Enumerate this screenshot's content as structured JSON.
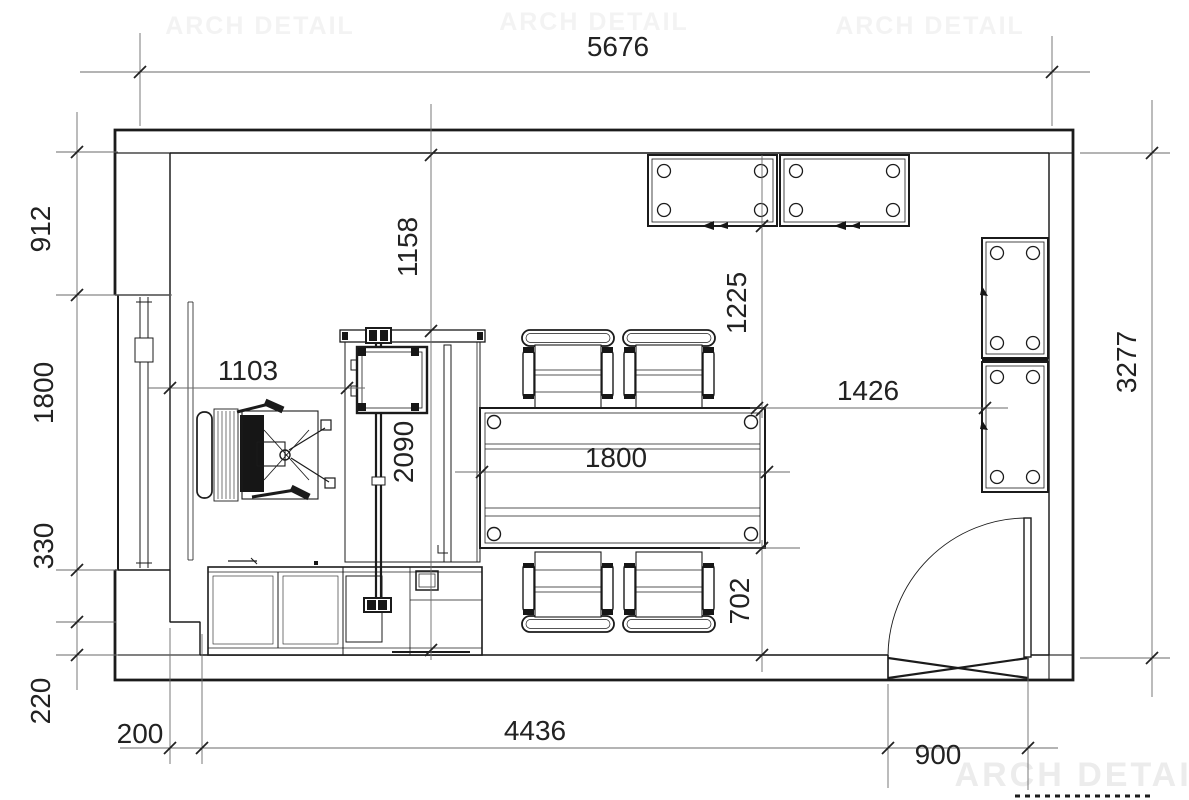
{
  "watermark": {
    "brand": "ARCH DETAIL"
  },
  "dims": {
    "top_total": "5676",
    "right_total": "3277",
    "left": {
      "pier": "912",
      "window": "1800",
      "sill": "330",
      "corner": "220"
    },
    "bottom": {
      "offset": "200",
      "span": "4436",
      "door": "900"
    },
    "inner": {
      "wall_to_desk": "1158",
      "window_to_desk": "1103",
      "partition": "2090",
      "cabinet_to_table": "1225",
      "table_length": "1800",
      "table_to_cabinet": "1426",
      "table_to_counter": "702"
    }
  }
}
